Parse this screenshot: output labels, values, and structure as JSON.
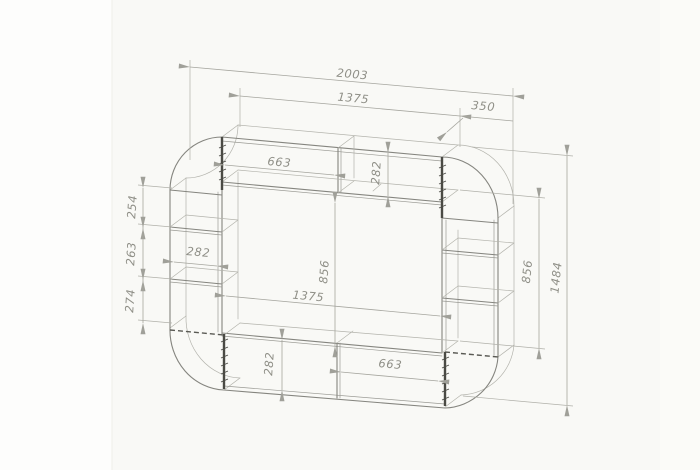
{
  "drawing": {
    "dims": [
      {
        "id": "overall-width",
        "value": "2003"
      },
      {
        "id": "top-inner-width",
        "value": "1375"
      },
      {
        "id": "side-module-width",
        "value": "350"
      },
      {
        "id": "top-shelf-width",
        "value": "663"
      },
      {
        "id": "top-shelf-height",
        "value": "282"
      },
      {
        "id": "left-shelf-gap-1",
        "value": "254"
      },
      {
        "id": "left-shelf-gap-2",
        "value": "263"
      },
      {
        "id": "left-shelf-gap-3",
        "value": "274"
      },
      {
        "id": "left-column-width",
        "value": "282"
      },
      {
        "id": "niche-height",
        "value": "856"
      },
      {
        "id": "niche-width",
        "value": "1375"
      },
      {
        "id": "bottom-shelf-height",
        "value": "282"
      },
      {
        "id": "bottom-shelf-width",
        "value": "663"
      },
      {
        "id": "right-side-height",
        "value": "856"
      },
      {
        "id": "overall-height",
        "value": "1484"
      }
    ],
    "colors": {
      "paper": "#f9f9f6",
      "line": "#85857f",
      "dim_line": "#a5a59e",
      "text": "#8f8f87",
      "edge_dark": "#4a4a44"
    }
  }
}
